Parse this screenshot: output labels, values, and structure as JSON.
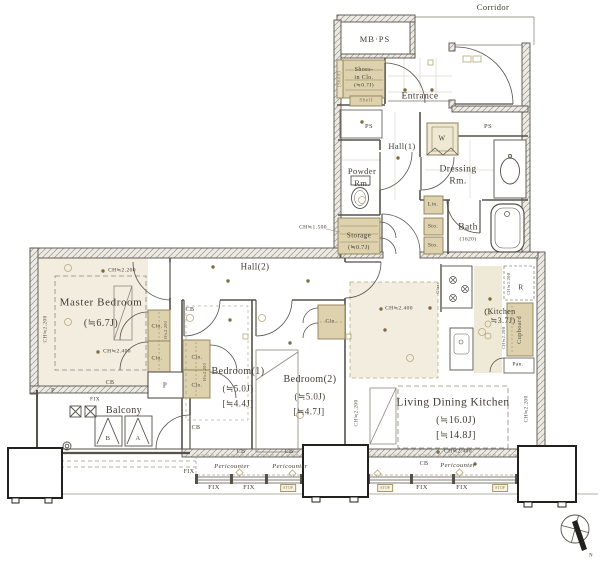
{
  "colors": {
    "wall": "#55524a",
    "closet_fill": "#ded2ae",
    "room_fill": "#f2edde",
    "accent": "#b5a878"
  },
  "corridor": {
    "label": "Corridor"
  },
  "compass": {
    "north": "N"
  },
  "ch": {
    "h2200": "CH≒2.200",
    "h2400": "CH≒2.400",
    "h1500": "CH≒1.500",
    "closet_h": "H≒2.200"
  },
  "upper": {
    "mbps": "MB·PS",
    "shoes_clo": {
      "l1": "Shoes-",
      "l2": "in Clo.",
      "l3": "(≒0.7J)"
    },
    "shelf_side": "(Shelf)",
    "shelf": "Shelf",
    "entrance": "Entrance",
    "ps": "PS",
    "hall1": "Hall(1)",
    "washer": "W",
    "powder": {
      "l1": "Powder",
      "l2": "Rm."
    },
    "dressing": {
      "l1": "Dressing",
      "l2": "Rm."
    },
    "lin": "Lin.",
    "sto": "Sto.",
    "storage": {
      "l1": "Storage",
      "l2": "(≒0.7J)"
    },
    "bath": {
      "l1": "Bath",
      "l2": "(1620)"
    }
  },
  "lower": {
    "master": {
      "name": "Master Bedroom",
      "size": "(≒6.7J)"
    },
    "hall2": "Hall(2)",
    "bedroom1": {
      "name": "Bedroom(1)",
      "size1": "(≒5.0J)",
      "size2": "[≒4.4J]"
    },
    "bedroom2": {
      "name": "Bedroom(2)",
      "size1": "(≒5.0J)",
      "size2": "[≒4.7J]"
    },
    "ldk": {
      "name": "Living Dining Kitchen",
      "size1": "(≒16.0J)",
      "size2": "[≒14.8J]"
    },
    "kitchen": {
      "l1": "(Kitchen",
      "l2": "≒3.7J)",
      "glass": "Glass",
      "r": "R",
      "cupboard": "Cupboard",
      "pan": "Pan."
    },
    "closet": "Clo.",
    "pillar": "P",
    "cb": "CB",
    "balcony": {
      "name": "Balcony",
      "a": "A",
      "b": "B"
    },
    "pericounter": "Pericounter",
    "fix": "FIX",
    "stop": "STOP"
  }
}
